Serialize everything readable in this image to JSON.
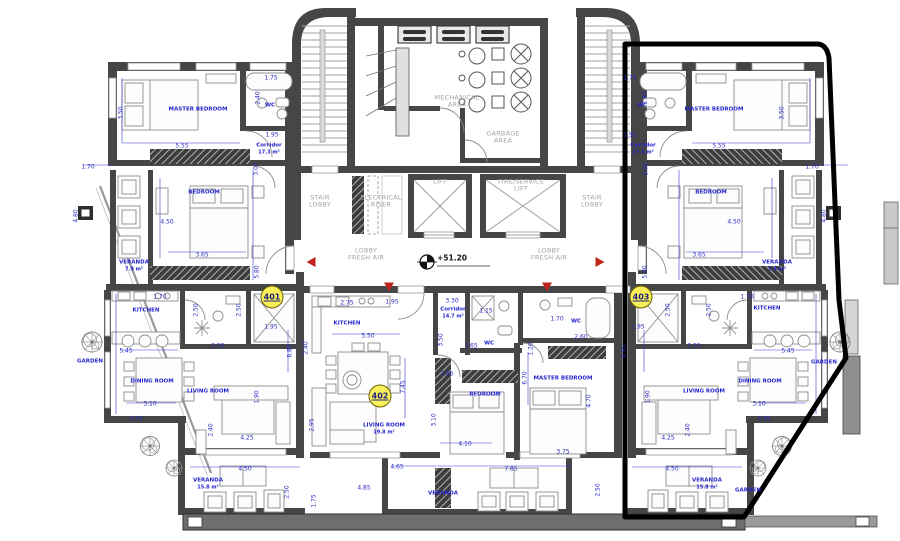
{
  "drawing": {
    "elevation_label": "+51.20",
    "colors": {
      "label_blue": "#2424cd",
      "dimension_blue": "#2a2ac2",
      "zone_gray": "#a3a3a3",
      "wall_gray": "#464646",
      "badge_yellow": "#f6ef5a",
      "marker_red": "#c0241c",
      "highlight_black": "#000000"
    },
    "unit_badges": [
      {
        "number": "401",
        "x": 272,
        "y": 297
      },
      {
        "number": "402",
        "x": 380,
        "y": 396
      },
      {
        "number": "403",
        "x": 641,
        "y": 297
      }
    ],
    "zones": [
      {
        "label": "MECHANICAL AREA",
        "x": 457,
        "y": 102,
        "w": 62
      },
      {
        "label": "GARBAGE AREA",
        "x": 503,
        "y": 138,
        "w": 52
      },
      {
        "label": "STAIR LOBBY",
        "x": 320,
        "y": 202,
        "w": 34
      },
      {
        "label": "ELECTRICAL RISER",
        "x": 381,
        "y": 202,
        "w": 52
      },
      {
        "label": "LIFT",
        "x": 440,
        "y": 182,
        "w": 40
      },
      {
        "label": "FIRE/SERVICE LIFT",
        "x": 521,
        "y": 186,
        "w": 56
      },
      {
        "label": "STAIR LOBBY",
        "x": 592,
        "y": 202,
        "w": 34
      },
      {
        "label": "LOBBY FRESH AIR",
        "x": 366,
        "y": 255,
        "w": 46
      },
      {
        "label": "LOBBY FRESH AIR",
        "x": 549,
        "y": 255,
        "w": 46
      }
    ],
    "rooms": [
      {
        "label": "MASTER BEDROOM",
        "x": 198,
        "y": 110
      },
      {
        "label": "WC",
        "x": 270,
        "y": 106
      },
      {
        "label": "Corridor",
        "area": "17.3 m²",
        "x": 269,
        "y": 149
      },
      {
        "label": "BEDROOM",
        "x": 204,
        "y": 193
      },
      {
        "label": "VERANDA",
        "area": "7.9 m²",
        "x": 134,
        "y": 266
      },
      {
        "label": "KITCHEN",
        "x": 146,
        "y": 311
      },
      {
        "label": "GARDEN",
        "x": 90,
        "y": 362
      },
      {
        "label": "DINING ROOM",
        "x": 152,
        "y": 382
      },
      {
        "label": "LIVING ROOM",
        "x": 208,
        "y": 392
      },
      {
        "label": "VERANDA",
        "area": "15.8 m²",
        "x": 208,
        "y": 484
      },
      {
        "label": "KITCHEN",
        "x": 347,
        "y": 324
      },
      {
        "label": "Corridor",
        "area": "14.7 m²",
        "x": 453,
        "y": 313
      },
      {
        "label": "WC",
        "x": 489,
        "y": 344
      },
      {
        "label": "WC",
        "x": 576,
        "y": 322
      },
      {
        "label": "BEDROOM",
        "x": 485,
        "y": 395
      },
      {
        "label": "MASTER BEDROOM",
        "x": 563,
        "y": 379
      },
      {
        "label": "LIVING ROOM",
        "area": "19.8 m²",
        "x": 384,
        "y": 429
      },
      {
        "label": "VERANDA",
        "x": 443,
        "y": 494
      },
      {
        "label": "MASTER BEDROOM",
        "x": 714,
        "y": 110
      },
      {
        "label": "WC",
        "x": 642,
        "y": 106
      },
      {
        "label": "Corridor",
        "area": "17.3 m²",
        "x": 643,
        "y": 149
      },
      {
        "label": "BEDROOM",
        "x": 711,
        "y": 193
      },
      {
        "label": "VERANDA",
        "area": "7.9 m²",
        "x": 777,
        "y": 266
      },
      {
        "label": "KITCHEN",
        "x": 767,
        "y": 309
      },
      {
        "label": "GARDEN",
        "x": 824,
        "y": 363
      },
      {
        "label": "DINING ROOM",
        "x": 760,
        "y": 382
      },
      {
        "label": "LIVING ROOM",
        "x": 704,
        "y": 392
      },
      {
        "label": "VERANDA",
        "area": "15.8 m²",
        "x": 707,
        "y": 484
      },
      {
        "label": "GARDEN",
        "x": 748,
        "y": 491
      }
    ],
    "dimensions": [
      {
        "t": "1.75",
        "x": 271,
        "y": 78
      },
      {
        "t": "2.40",
        "x": 258,
        "y": 98,
        "v": true
      },
      {
        "t": "3.50",
        "x": 121,
        "y": 113,
        "v": true
      },
      {
        "t": "5.55",
        "x": 182,
        "y": 146
      },
      {
        "t": "1.95",
        "x": 272,
        "y": 135
      },
      {
        "t": "3.00",
        "x": 256,
        "y": 169,
        "v": true
      },
      {
        "t": "1.70",
        "x": 88,
        "y": 167
      },
      {
        "t": "4.80",
        "x": 76,
        "y": 216,
        "v": true
      },
      {
        "t": "4.50",
        "x": 167,
        "y": 222
      },
      {
        "t": "3.65",
        "x": 202,
        "y": 255
      },
      {
        "t": "5.80",
        "x": 257,
        "y": 272,
        "v": true
      },
      {
        "t": "1.70",
        "x": 160,
        "y": 297
      },
      {
        "t": "2.50",
        "x": 196,
        "y": 310,
        "v": true
      },
      {
        "t": "2.50",
        "x": 239,
        "y": 310,
        "v": true
      },
      {
        "t": "2.55",
        "x": 218,
        "y": 346
      },
      {
        "t": "5.45",
        "x": 126,
        "y": 351
      },
      {
        "t": "1.95",
        "x": 271,
        "y": 327
      },
      {
        "t": "8.85",
        "x": 290,
        "y": 351,
        "v": true
      },
      {
        "t": "3.10",
        "x": 150,
        "y": 404
      },
      {
        "t": "3.35",
        "x": 136,
        "y": 419
      },
      {
        "t": "1.90",
        "x": 257,
        "y": 397,
        "v": true
      },
      {
        "t": "2.40",
        "x": 211,
        "y": 430,
        "v": true
      },
      {
        "t": "4.25",
        "x": 247,
        "y": 438
      },
      {
        "t": "4.50",
        "x": 245,
        "y": 469
      },
      {
        "t": "2.50",
        "x": 287,
        "y": 492,
        "v": true
      },
      {
        "t": "1.75",
        "x": 314,
        "y": 501,
        "v": true
      },
      {
        "t": "2.75",
        "x": 347,
        "y": 303
      },
      {
        "t": "1.95",
        "x": 392,
        "y": 302
      },
      {
        "t": "3.30",
        "x": 452,
        "y": 301
      },
      {
        "t": "1.15",
        "x": 486,
        "y": 311
      },
      {
        "t": "2.40",
        "x": 306,
        "y": 348,
        "v": true
      },
      {
        "t": "5.50",
        "x": 368,
        "y": 336
      },
      {
        "t": "3.50",
        "x": 441,
        "y": 340,
        "v": true
      },
      {
        "t": "1.65",
        "x": 471,
        "y": 346
      },
      {
        "t": "7.45",
        "x": 403,
        "y": 387,
        "v": true
      },
      {
        "t": "1.85",
        "x": 447,
        "y": 374
      },
      {
        "t": "3.10",
        "x": 434,
        "y": 420,
        "v": true
      },
      {
        "t": "4.10",
        "x": 465,
        "y": 444
      },
      {
        "t": "1.20",
        "x": 531,
        "y": 349,
        "v": true
      },
      {
        "t": "6.70",
        "x": 525,
        "y": 378,
        "v": true
      },
      {
        "t": "1.70",
        "x": 557,
        "y": 319
      },
      {
        "t": "2.60",
        "x": 581,
        "y": 337
      },
      {
        "t": "4.70",
        "x": 589,
        "y": 401,
        "v": true
      },
      {
        "t": "3.75",
        "x": 563,
        "y": 452
      },
      {
        "t": "2.95",
        "x": 312,
        "y": 425,
        "v": true
      },
      {
        "t": "4.65",
        "x": 397,
        "y": 467
      },
      {
        "t": "4.85",
        "x": 364,
        "y": 488
      },
      {
        "t": "7.85",
        "x": 511,
        "y": 469
      },
      {
        "t": "2.50",
        "x": 598,
        "y": 490,
        "v": true
      },
      {
        "t": "1.75",
        "x": 630,
        "y": 78
      },
      {
        "t": "2.40",
        "x": 645,
        "y": 98,
        "v": true
      },
      {
        "t": "3.50",
        "x": 782,
        "y": 113,
        "v": true
      },
      {
        "t": "5.55",
        "x": 719,
        "y": 146
      },
      {
        "t": "1.95",
        "x": 630,
        "y": 135
      },
      {
        "t": "3.00",
        "x": 646,
        "y": 169,
        "v": true
      },
      {
        "t": "1.70",
        "x": 812,
        "y": 167
      },
      {
        "t": "4.80",
        "x": 824,
        "y": 216,
        "v": true
      },
      {
        "t": "4.50",
        "x": 734,
        "y": 222
      },
      {
        "t": "3.65",
        "x": 699,
        "y": 255
      },
      {
        "t": "5.80",
        "x": 645,
        "y": 272,
        "v": true
      },
      {
        "t": "1.70",
        "x": 747,
        "y": 297
      },
      {
        "t": "2.50",
        "x": 668,
        "y": 310,
        "v": true
      },
      {
        "t": "2.50",
        "x": 709,
        "y": 310,
        "v": true
      },
      {
        "t": "2.55",
        "x": 694,
        "y": 346
      },
      {
        "t": "5.45",
        "x": 788,
        "y": 351
      },
      {
        "t": "1.95",
        "x": 638,
        "y": 327
      },
      {
        "t": "8.85",
        "x": 624,
        "y": 351,
        "v": true
      },
      {
        "t": "3.10",
        "x": 759,
        "y": 404
      },
      {
        "t": "3.35",
        "x": 764,
        "y": 419
      },
      {
        "t": "1.90",
        "x": 648,
        "y": 397,
        "v": true
      },
      {
        "t": "2.40",
        "x": 688,
        "y": 430,
        "v": true
      },
      {
        "t": "4.25",
        "x": 668,
        "y": 438
      },
      {
        "t": "4.50",
        "x": 672,
        "y": 469
      }
    ],
    "markers": [
      {
        "dir": "left",
        "x": 311,
        "y": 262
      },
      {
        "dir": "down",
        "x": 389,
        "y": 287
      },
      {
        "dir": "down",
        "x": 547,
        "y": 287
      },
      {
        "dir": "right",
        "x": 600,
        "y": 262
      }
    ]
  }
}
